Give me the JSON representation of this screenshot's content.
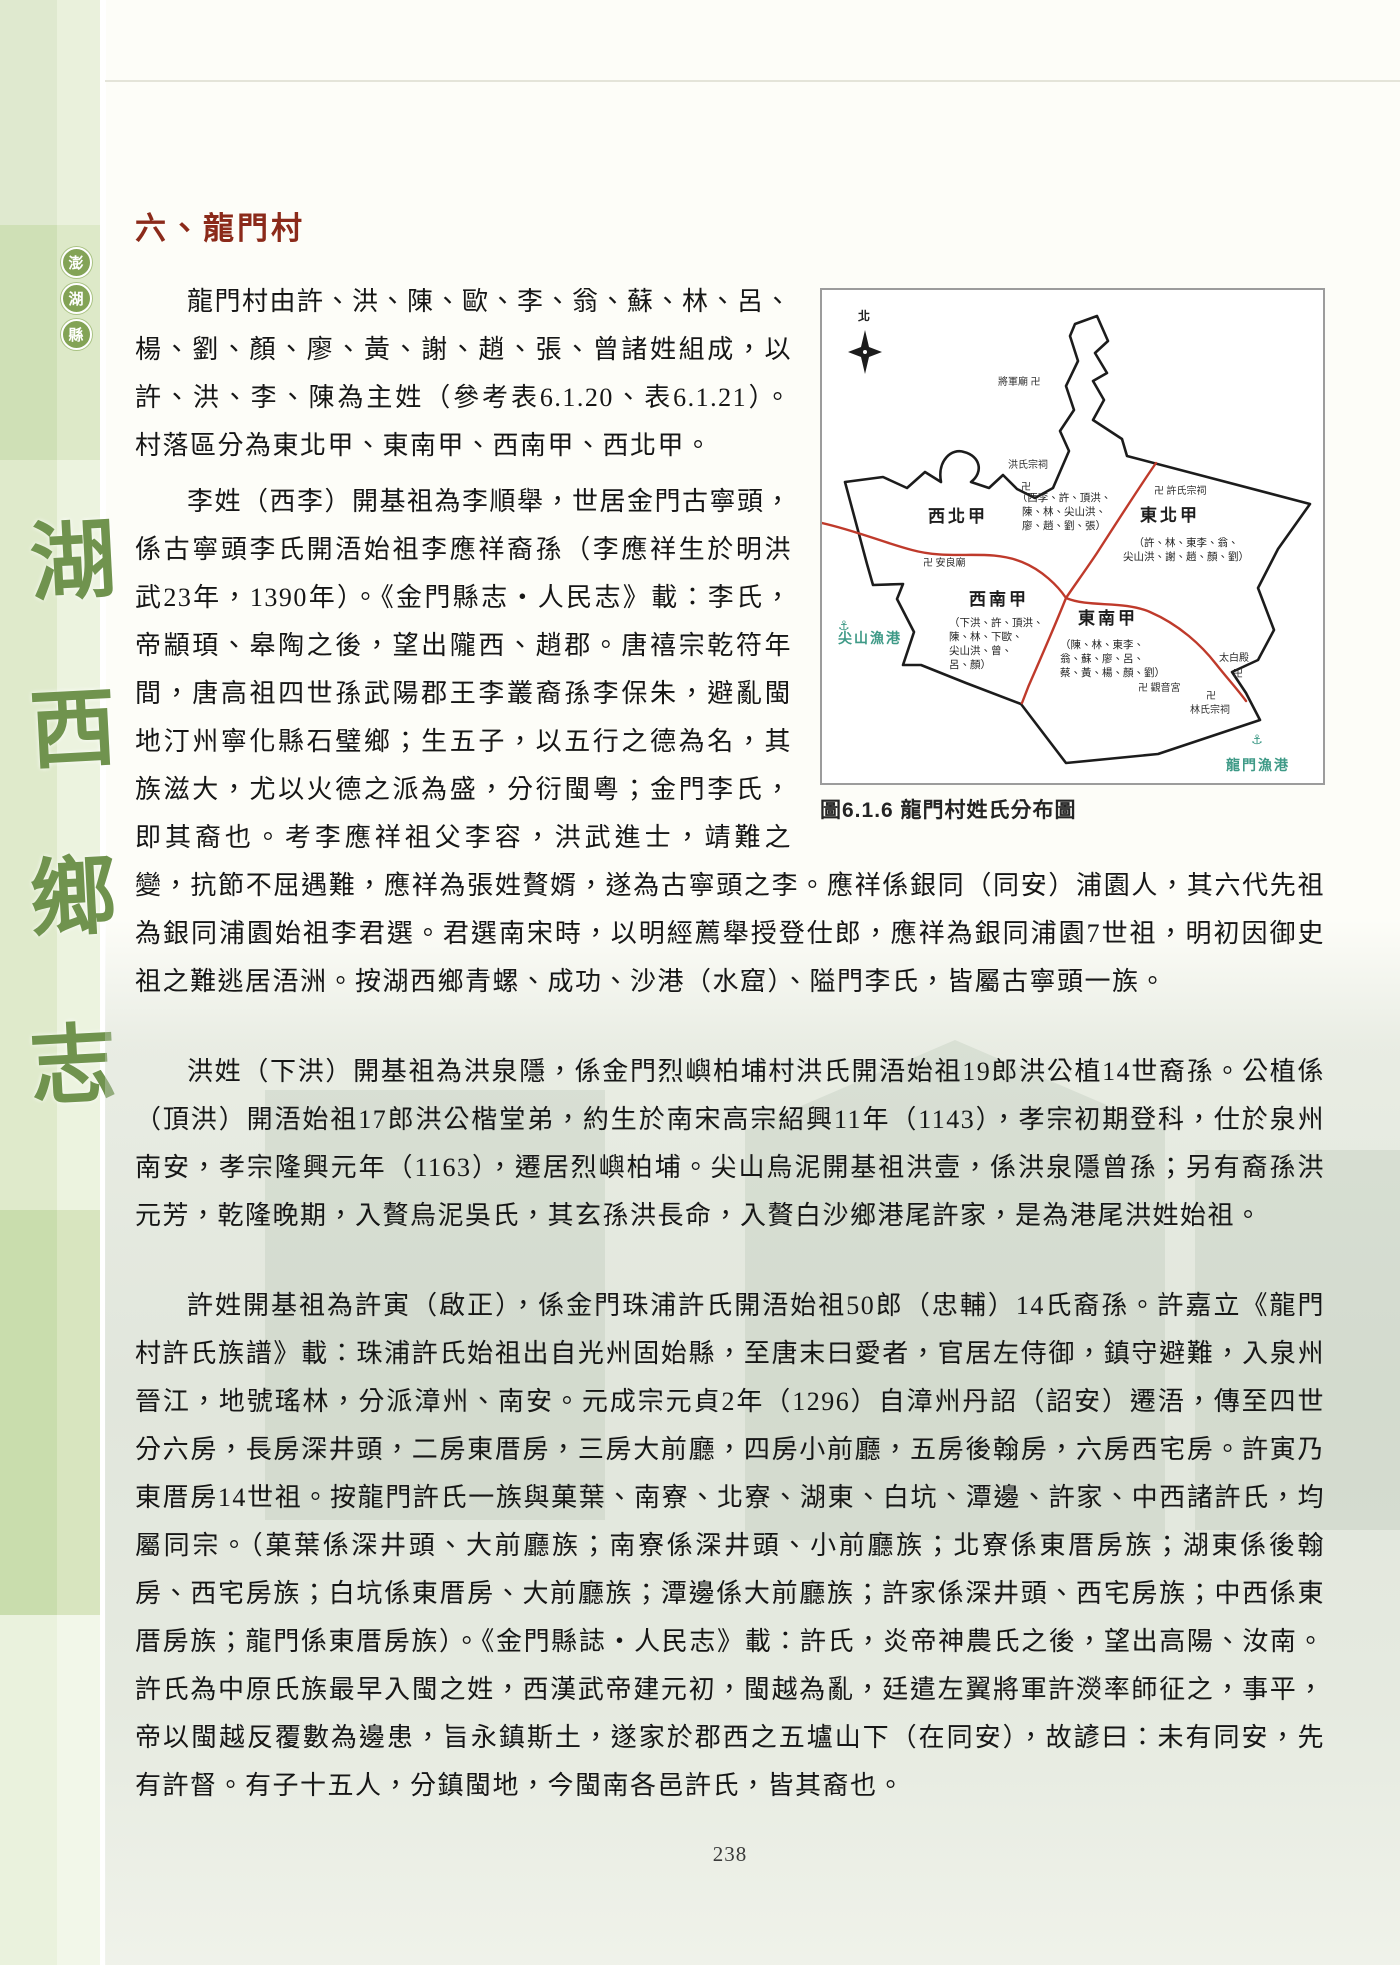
{
  "sidebar": {
    "badge_chars": [
      "澎",
      "湖",
      "縣"
    ],
    "book_title_chars": [
      "湖",
      "西",
      "鄉",
      "志"
    ]
  },
  "content": {
    "section_title": "六、龍門村",
    "paragraphs": {
      "p1": "龍門村由許、洪、陳、歐、李、翁、蘇、林、呂、楊、劉、顏、廖、黃、謝、趙、張、曾諸姓組成，以許、洪、李、陳為主姓（參考表6.1.20、表6.1.21）。村落區分為東北甲、東南甲、西南甲、西北甲。",
      "p2": "李姓（西李）開基祖為李順舉，世居金門古寧頭，係古寧頭李氏開浯始祖李應祥裔孫（李應祥生於明洪武23年，1390年）。《金門縣志‧人民志》載：李氏，帝顓頊、皋陶之後，望出隴西、趙郡。唐禧宗乾符年間，唐高祖四世孫武陽郡王李叢裔孫李保朱，避亂閩地汀州寧化縣石璧鄉；生五子，以五行之德為名，其族滋大，尤以火德之派為盛，分衍閩粵；金門李氏，即其裔也。考李應祥祖父李容，洪武進士，靖難之變，抗節不屈遇難，應祥為張姓贅婿，遂為古寧頭之李。應祥係銀同（同安）浦園人，其六代先祖為銀同浦園始祖李君選。君選南宋時，以明經薦舉授登仕郎，應祥為銀同浦園7世祖，明初因御史祖之難逃居浯洲。按湖西鄉青螺、成功、沙港（水窟）、隘門李氏，皆屬古寧頭一族。",
      "p3": "洪姓（下洪）開基祖為洪泉隱，係金門烈嶼柏埔村洪氏開浯始祖19郎洪公植14世裔孫。公植係（頂洪）開浯始祖17郎洪公楷堂弟，約生於南宋高宗紹興11年（1143），孝宗初期登科，仕於泉州南安，孝宗隆興元年（1163），遷居烈嶼柏埔。尖山烏泥開基祖洪壹，係洪泉隱曾孫；另有裔孫洪元芳，乾隆晚期，入贅烏泥吳氏，其玄孫洪長命，入贅白沙鄉港尾許家，是為港尾洪姓始祖。",
      "p4": "許姓開基祖為許寅（啟正），係金門珠浦許氏開浯始祖50郎（忠輔）14氏裔孫。許嘉立《龍門村許氏族譜》載：珠浦許氏始祖出自光州固始縣，至唐末曰愛者，官居左侍御，鎮守避難，入泉州晉江，地號瑤林，分派漳州、南安。元成宗元貞2年（1296）自漳州丹詔（詔安）遷浯，傳至四世分六房，長房深井頭，二房東厝房，三房大前廳，四房小前廳，五房後翰房，六房西宅房。許寅乃東厝房14世祖。按龍門許氏一族與菓葉、南寮、北寮、湖東、白坑、潭邊、許家、中西諸許氏，均屬同宗。（菓葉係深井頭、大前廳族；南寮係深井頭、小前廳族；北寮係東厝房族；湖東係後翰房、西宅房族；白坑係東厝房、大前廳族；潭邊係大前廳族；許家係深井頭、西宅房族；中西係東厝房族；龍門係東厝房族）。《金門縣誌‧人民志》載：許氏，炎帝神農氏之後，望出高陽、汝南。許氏為中原氏族最早入閩之姓，西漢武帝建元初，閩越為亂，廷遣左翼將軍許濙率師征之，事平，帝以閩越反覆數為邊患，旨永鎮斯土，遂家於郡西之五壚山下（在同安），故諺曰：未有同安，先有許督。有子十五人，分鎮閩地，今閩南各邑許氏，皆其裔也。"
    },
    "page_number": "238"
  },
  "figure": {
    "caption": "圖6.1.6 龍門村姓氏分布圖",
    "compass_label": "北",
    "regions": {
      "xibei": {
        "name": "西北甲",
        "members": "（西李、許、頂洪、\n陳、林、尖山洪、\n廖、趙、劉、張）"
      },
      "dongbei": {
        "name": "東北甲",
        "members": "（許、林、東李、翁、\n尖山洪、謝、趙、顏、劉）"
      },
      "xinan": {
        "name": "西南甲",
        "members": "（下洪、許、頂洪、\n陳、林、下歐、\n尖山洪、曾、\n呂、顏）"
      },
      "dongnan": {
        "name": "東南甲",
        "members": "（陳、林、東李、\n翁、蘇、廖、呂、\n蔡、黃、楊、顏、劉）"
      }
    },
    "landmarks": {
      "jiangjun_temple": "將軍廟 卍",
      "hong_shrine_name": "洪氏宗祠",
      "hong_shrine_sym": "卍",
      "xu_shrine": "卍 許氏宗祠",
      "anliang_temple": "卍 安良廟",
      "guanyin_temple": "卍 觀音宮",
      "taibai_name": "太白殿",
      "taibai_sym": "卍",
      "lin_shrine_sym": "卍",
      "lin_shrine_name": "林氏宗祠",
      "jianshan_harbor": "尖山漁港",
      "longmen_harbor": "龍門漁港",
      "anchor_icon": "⚓"
    },
    "colors": {
      "boundary": "#1c1c1c",
      "road": "#bf3a2b",
      "anchor": "#3f9a87",
      "title_red": "#8b2a1a",
      "sidebar_green": "#70934e"
    }
  }
}
